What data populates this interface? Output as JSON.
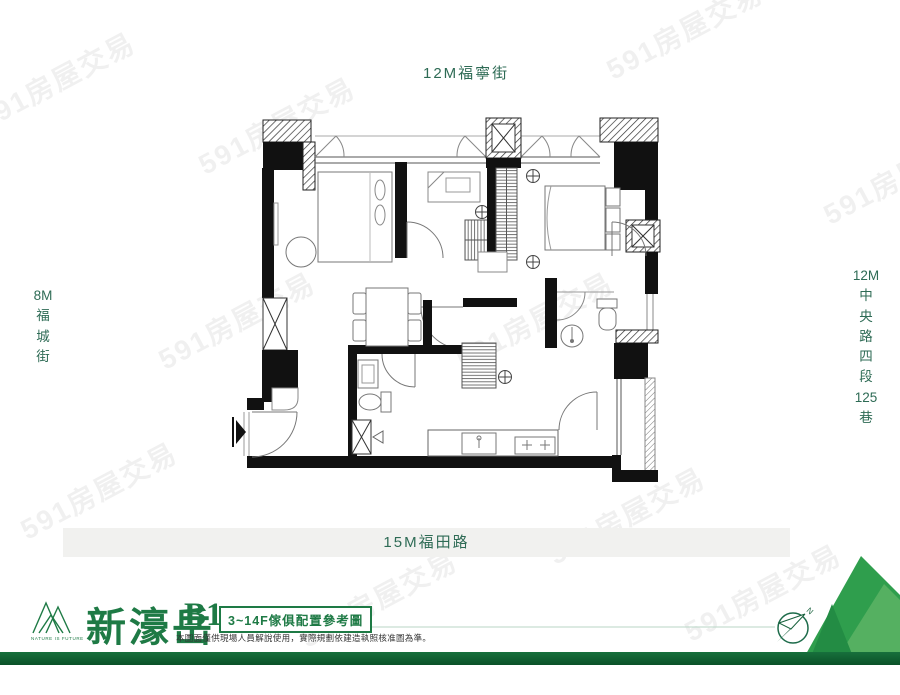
{
  "streets": {
    "top": "12M福寧街",
    "left_chars": [
      "8M",
      "福",
      "城",
      "街"
    ],
    "right_chars": [
      "12M",
      "中",
      "央",
      "路",
      "四",
      "段",
      "125",
      "巷"
    ],
    "bottom": "15M福田路"
  },
  "watermark": {
    "text": "591房屋交易"
  },
  "brand": {
    "name": "新濠岳",
    "logo_caption": "NATURE IS FUTURE",
    "unit": "B1",
    "plan_note": "3~14F傢俱配置參考圖",
    "disclaimer": "本圖面僅供現場人員解說使用，實際規劃依建造執照核准圖為準。"
  },
  "compass": {
    "north_label": "N"
  },
  "colors": {
    "brand_green": "#1e7a45",
    "street_text": "#2e6b55",
    "road_bar_bg": "#f1f1ef",
    "footer_bar": "#0b5128",
    "wall_black": "#111111",
    "mountain_green": "#2f9e4d"
  }
}
